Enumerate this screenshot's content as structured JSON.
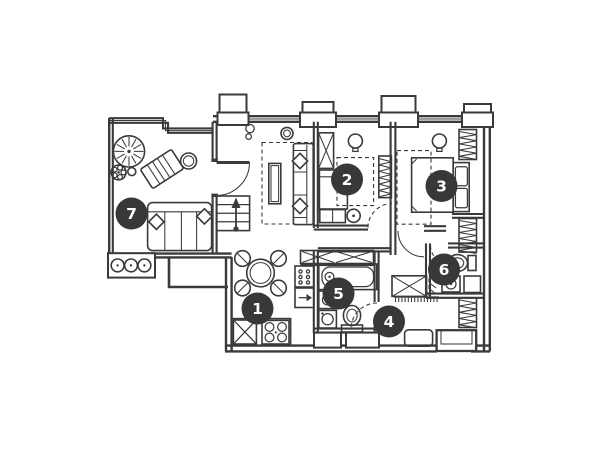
{
  "page": {
    "background": "#ffffff"
  },
  "palette": {
    "line": "#3a3a3a",
    "marker_fill": "#383838",
    "marker_text": "#ffffff"
  },
  "floor_plan": {
    "type": "apartment-floor-plan",
    "marker_radius": 16,
    "marker_font_size": 15.5,
    "room_markers": [
      {
        "label": "1",
        "x": 257.5,
        "y": 308.5
      },
      {
        "label": "2",
        "x": 347.0,
        "y": 179.5
      },
      {
        "label": "3",
        "x": 441.5,
        "y": 186.0
      },
      {
        "label": "4",
        "x": 389.0,
        "y": 321.5
      },
      {
        "label": "5",
        "x": 338.5,
        "y": 293.5
      },
      {
        "label": "6",
        "x": 444.0,
        "y": 269.5
      },
      {
        "label": "7",
        "x": 131.5,
        "y": 213.5
      }
    ]
  }
}
